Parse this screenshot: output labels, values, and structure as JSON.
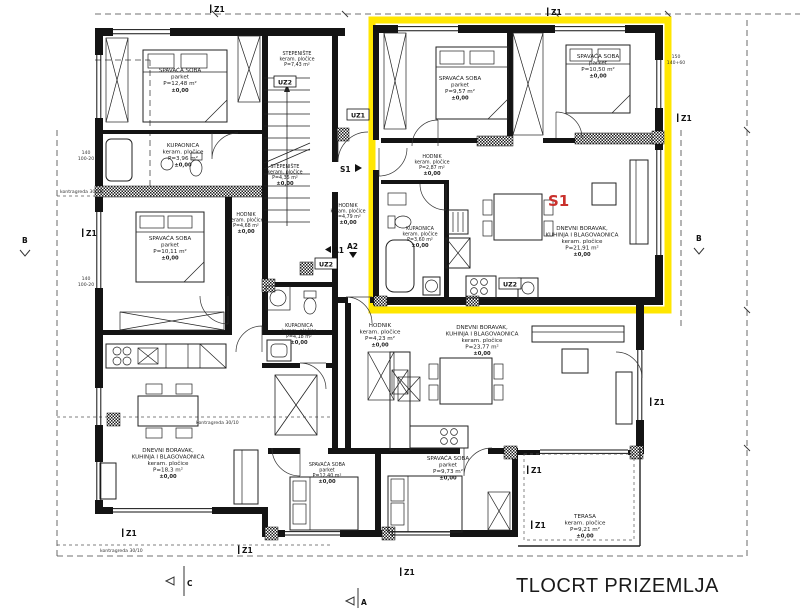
{
  "page": {
    "title": "TLOCRT PRIZEMLJA"
  },
  "unit": {
    "label": "S1",
    "box_color": "#ffe600",
    "label_color": "#c9302c"
  },
  "markers": {
    "z1": "Z1",
    "uz1": "UZ1",
    "uz2": "UZ2",
    "a1": "A1",
    "a2": "A2",
    "b": "B",
    "c": "C",
    "a": "A",
    "s1": "S1"
  },
  "annotations": {
    "kontragreda": "kontragreda 30/10",
    "dim_140": "140",
    "dim_100_20": "100-20",
    "dim_150": "150",
    "dim_140_60": "140+60",
    "elev": "±0,00"
  },
  "rooms": [
    {
      "name": "SPAVAĆA SOBA",
      "floor": "parket",
      "area": "P=12,48 m²",
      "elev": "±0,00"
    },
    {
      "name": "KUPAONICA",
      "floor": "keram. pločice",
      "area": "P=3,96 m²",
      "elev": "±0,00"
    },
    {
      "name": "STEPENIŠTE",
      "floor": "keram. pločice",
      "area": "P=7,43 m²",
      "elev": ""
    },
    {
      "name": "STEPENIŠTE",
      "floor": "keram. pločice",
      "area": "P=4,35 m²",
      "elev": "±0,00"
    },
    {
      "name": "SPAVAĆA SOBA",
      "floor": "parket",
      "area": "P=10,11 m²",
      "elev": "±0,00"
    },
    {
      "name": "HODNIK",
      "floor": "keram. pločice",
      "area": "P=4,68 m²",
      "elev": "±0,00"
    },
    {
      "name": "KUPAONICA",
      "floor": "keram. pločice",
      "area": "P=4,18 m²",
      "elev": "±0,00"
    },
    {
      "name": "DNEVNI BORAVAK,",
      "name2": "KUHINJA I BLAGOVAONICA",
      "floor": "keram. pločice",
      "area": "P=18,3 m²",
      "elev": "±0,00"
    },
    {
      "name": "SPAVAĆA SOBA",
      "floor": "parket",
      "area": "P=12,40 m²",
      "elev": "±0,00"
    },
    {
      "name": "SPAVAĆA SOBA",
      "floor": "parket",
      "area": "P=9,73 m²",
      "elev": "±0,00"
    },
    {
      "name": "HODNIK",
      "floor": "keram. pločice",
      "area": "P=4,23 m²",
      "elev": "±0,00"
    },
    {
      "name": "DNEVNI BORAVAK,",
      "name2": "KUHINJA I BLAGOVAONICA",
      "floor": "keram. pločice",
      "area": "P=23,77 m²",
      "elev": "±0,00"
    },
    {
      "name": "TERASA",
      "floor": "keram. pločice",
      "area": "P=9,21 m²",
      "elev": "±0,00"
    },
    {
      "name": "SPAVAĆA SOBA",
      "floor": "parket",
      "area": "P=9,57 m²",
      "elev": "±0,00"
    },
    {
      "name": "SPAVAĆA SOBA",
      "floor": "parket",
      "area": "P=10,50 m²",
      "elev": "±0,00"
    },
    {
      "name": "HODNIK",
      "floor": "keram. pločice",
      "area": "P=2,87 m²",
      "elev": "±0,00"
    },
    {
      "name": "KUPAONICA",
      "floor": "keram. pločice",
      "area": "P=3,60 m²",
      "elev": "±0,00"
    },
    {
      "name": "DNEVNI BORAVAK,",
      "name2": "KUHINJA I BLAGOVAONICA",
      "floor": "keram. pločice",
      "area": "P=21,91 m²",
      "elev": "±0,00"
    },
    {
      "name": "HODNIK",
      "floor": "keram. pločice",
      "area": "P=4,79 m²",
      "elev": "±0,00"
    }
  ]
}
